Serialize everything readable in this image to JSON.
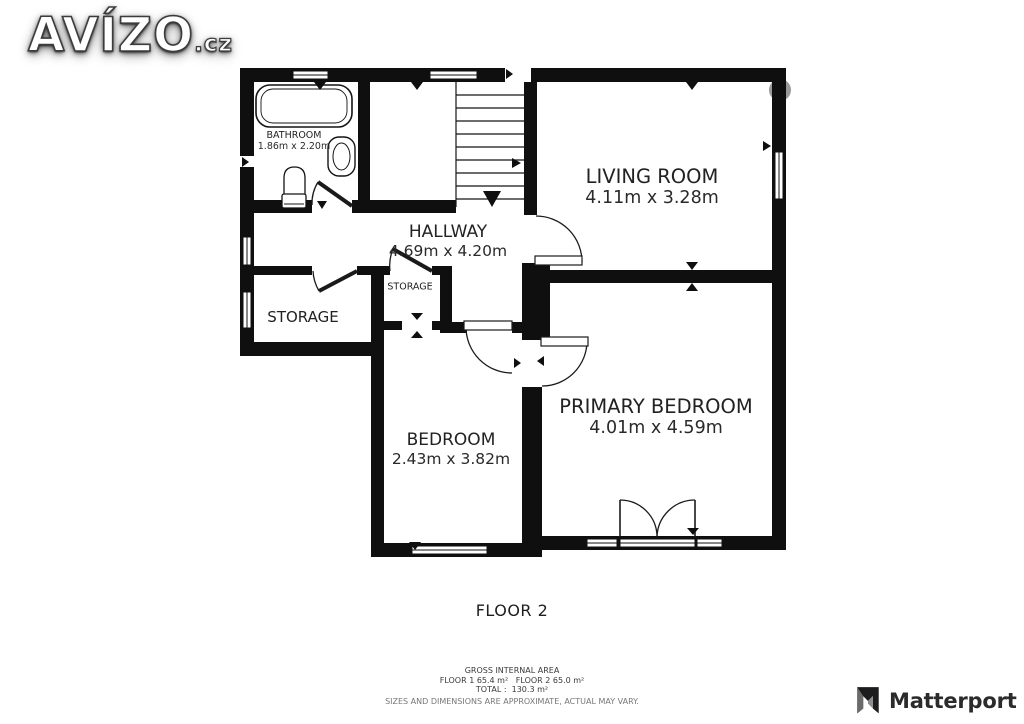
{
  "brand": {
    "name": "AVÍZO",
    "suffix": ".cz"
  },
  "floor_plan": {
    "caption": "FLOOR 2",
    "rooms": [
      {
        "id": "bathroom",
        "name": "BATHROOM",
        "dims": "1.86m x 2.20m"
      },
      {
        "id": "hallway",
        "name": "HALLWAY",
        "dims": "4.69m x 4.20m"
      },
      {
        "id": "living-room",
        "name": "LIVING ROOM",
        "dims": "4.11m x 3.28m"
      },
      {
        "id": "storage",
        "name": "STORAGE"
      },
      {
        "id": "storage-small",
        "name": "STORAGE"
      },
      {
        "id": "bedroom",
        "name": "BEDROOM",
        "dims": "2.43m x 3.82m"
      },
      {
        "id": "primary-bedroom",
        "name": "PRIMARY BEDROOM",
        "dims": "4.01m x 4.59m"
      }
    ],
    "fixtures": [
      "bathtub-icon",
      "sink-icon",
      "toilet-icon",
      "stairs-icon"
    ]
  },
  "footer": {
    "line1": "GROSS INTERNAL AREA",
    "line2": "FLOOR 1 65.4 m²   FLOOR 2 65.0 m²",
    "line3": "TOTAL :  130.3 m²",
    "line4": "SIZES AND DIMENSIONS ARE APPROXIMATE, ACTUAL MAY VARY."
  },
  "watermark": {
    "brand": "Matterport"
  },
  "colors": {
    "wall": "#0f0f0f",
    "background": "#ffffff",
    "label": "#222222",
    "footer_muted": "#777777"
  }
}
